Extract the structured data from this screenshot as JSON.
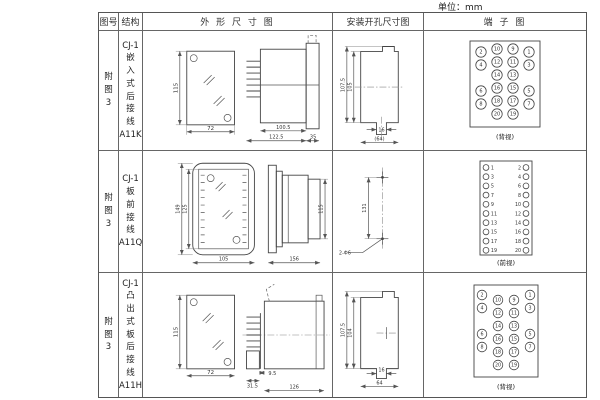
{
  "unit_label": "单位：mm",
  "headers": {
    "fig": "图号",
    "struct": "结构",
    "outline": "外 形 尺 寸 图",
    "mount": "安装开孔尺寸图",
    "terminal": "端 子 图"
  },
  "rows": [
    {
      "fig": "附\n图\n3",
      "struct": "CJ-1\n嵌\n入\n式\n后\n接\n线\nA11K",
      "outline": {
        "h": "115",
        "w": "72",
        "d1": "100.5",
        "d2": "122.5",
        "d3": "35"
      },
      "mount": {
        "v1": "107.5",
        "v2": "105",
        "w1": "16",
        "w2": "(64)"
      },
      "terminal_caption": "(背视)",
      "terminal_rows": [
        [
          2,
          10,
          9,
          1
        ],
        [
          4,
          12,
          11,
          3
        ],
        [
          null,
          14,
          13,
          null
        ],
        [
          6,
          16,
          15,
          5
        ],
        [
          8,
          18,
          17,
          7
        ],
        [
          null,
          20,
          19,
          null
        ]
      ]
    },
    {
      "fig": "附\n图\n3",
      "struct": "CJ-1\n板\n前\n接\n线\nA11Q",
      "outline": {
        "h1": "149",
        "h2": "125",
        "w": "105",
        "d": "156",
        "side_h": "115"
      },
      "mount": {
        "v": "131",
        "hole": "2-Φ6"
      },
      "terminal_caption": "(前视)",
      "terminal_rows": [
        [
          1,
          2
        ],
        [
          3,
          4
        ],
        [
          5,
          6
        ],
        [
          7,
          8
        ],
        [
          9,
          10
        ],
        [
          11,
          12
        ],
        [
          13,
          14
        ],
        [
          15,
          16
        ],
        [
          17,
          18
        ],
        [
          19,
          20
        ]
      ]
    },
    {
      "fig": "附\n图\n3",
      "struct": "CJ-1\n凸\n出\n式\n板\n后\n接\n线\nA11H",
      "outline": {
        "h": "115",
        "w": "72",
        "d1": "9.5",
        "d2": "31.5",
        "d3": "126"
      },
      "mount": {
        "v1": "107.5",
        "v2": "104",
        "w1": "16",
        "w2": "64"
      },
      "terminal_caption": "(背视)",
      "terminal_rows": [
        [
          2,
          10,
          9,
          1
        ],
        [
          4,
          12,
          11,
          3
        ],
        [
          null,
          14,
          13,
          null
        ],
        [
          6,
          16,
          15,
          5
        ],
        [
          8,
          18,
          17,
          7
        ],
        [
          null,
          20,
          19,
          null
        ]
      ]
    }
  ]
}
